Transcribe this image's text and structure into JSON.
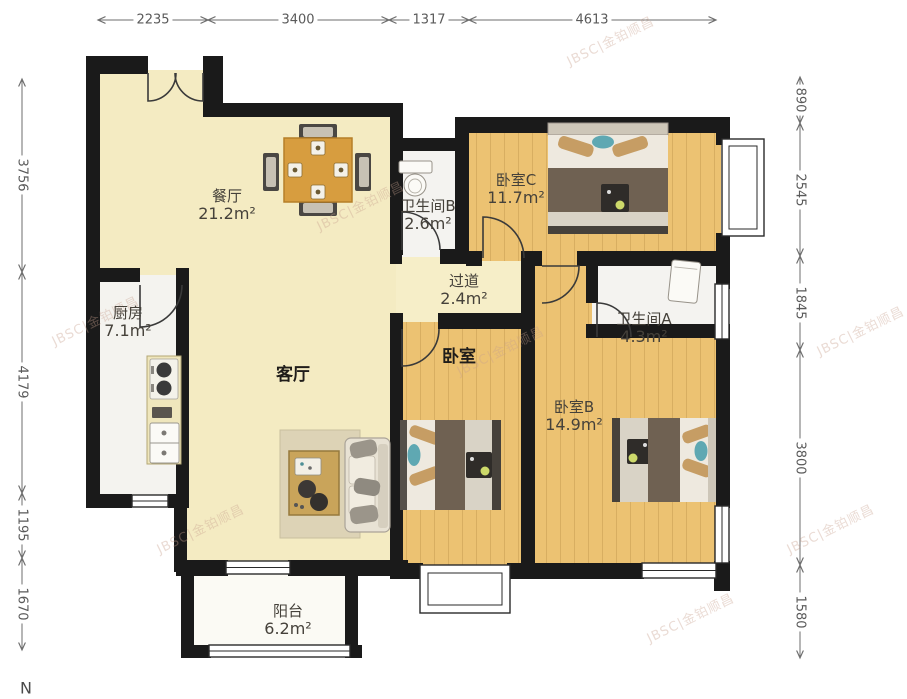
{
  "plan": {
    "rooms": {
      "dining": {
        "name": "餐厅",
        "area": "21.2m²"
      },
      "bathroom_b": {
        "name": "卫生间B",
        "area": "2.6m²"
      },
      "bedroom_c": {
        "name": "卧室C",
        "area": "11.7m²"
      },
      "hallway": {
        "name": "过道",
        "area": "2.4m²"
      },
      "kitchen": {
        "name": "厨房",
        "area": "7.1m²"
      },
      "living": {
        "name": "客厅"
      },
      "bedroom": {
        "name": "卧室"
      },
      "bathroom_a": {
        "name": "卫生间A",
        "area": "4.3m²"
      },
      "bedroom_b": {
        "name": "卧室B",
        "area": "14.9m²"
      },
      "balcony": {
        "name": "阳台",
        "area": "6.2m²"
      }
    },
    "dimensions_mm": {
      "top": [
        "2235",
        "3400",
        "1317",
        "4613"
      ],
      "left": [
        "3756",
        "4179",
        "1195",
        "1670"
      ],
      "right": [
        "890",
        "2545",
        "1845",
        "3800",
        "1580"
      ]
    },
    "compass": {
      "north": "N"
    },
    "watermark": {
      "text": "JBSC|金铂顺昌"
    },
    "colors": {
      "wall": "#1a1a1a",
      "floor_public": "#f4ebc2",
      "floor_wood": "#ecc272",
      "floor_wet": "#f4f3f0",
      "floor_balcony": "#fbfaf4",
      "accent_teal": "#5fa8b2",
      "blanket_brown": "#6f6152"
    }
  }
}
